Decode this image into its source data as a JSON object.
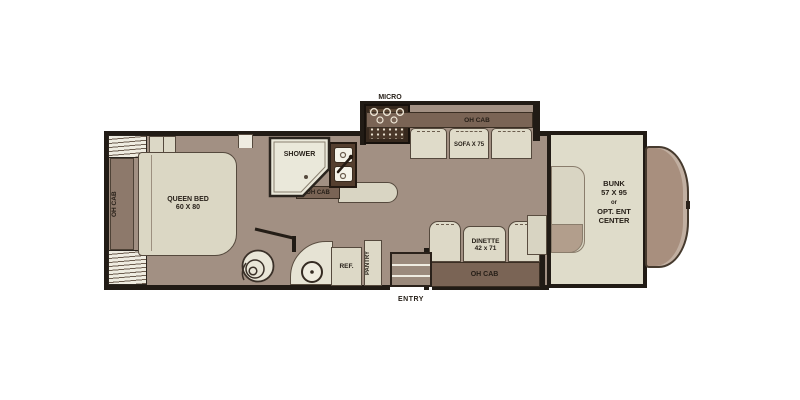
{
  "colors": {
    "background": "#ffffff",
    "wall": "#211b15",
    "floor": "#a29083",
    "furniture_light": "#dcd8c6",
    "cabinet_dark": "#7a6455",
    "cabinet_mid": "#8d796b",
    "exterior_cab": "#a88f7e"
  },
  "bedroom": {
    "oh_cab": "OH CAB",
    "bed_name": "QUEEN BED",
    "bed_size": "60 X 80"
  },
  "bath": {
    "shower": "SHOWER"
  },
  "galley": {
    "micro": "MICRO",
    "oh_cab": "OH CAB",
    "ref": "REF.",
    "pantry": "PANTRY"
  },
  "slideout": {
    "oh_cab": "OH CAB",
    "sofa": "SOFA X 75"
  },
  "dinette": {
    "name": "DINETTE",
    "size": "42 x 71",
    "oh_cab": "OH CAB"
  },
  "entry": {
    "label": "ENTRY"
  },
  "front": {
    "bunk_line1": "BUNK",
    "bunk_line2": "57 X 95",
    "bunk_line3": "or",
    "bunk_line4": "OPT. ENT",
    "bunk_line5": "CENTER"
  }
}
